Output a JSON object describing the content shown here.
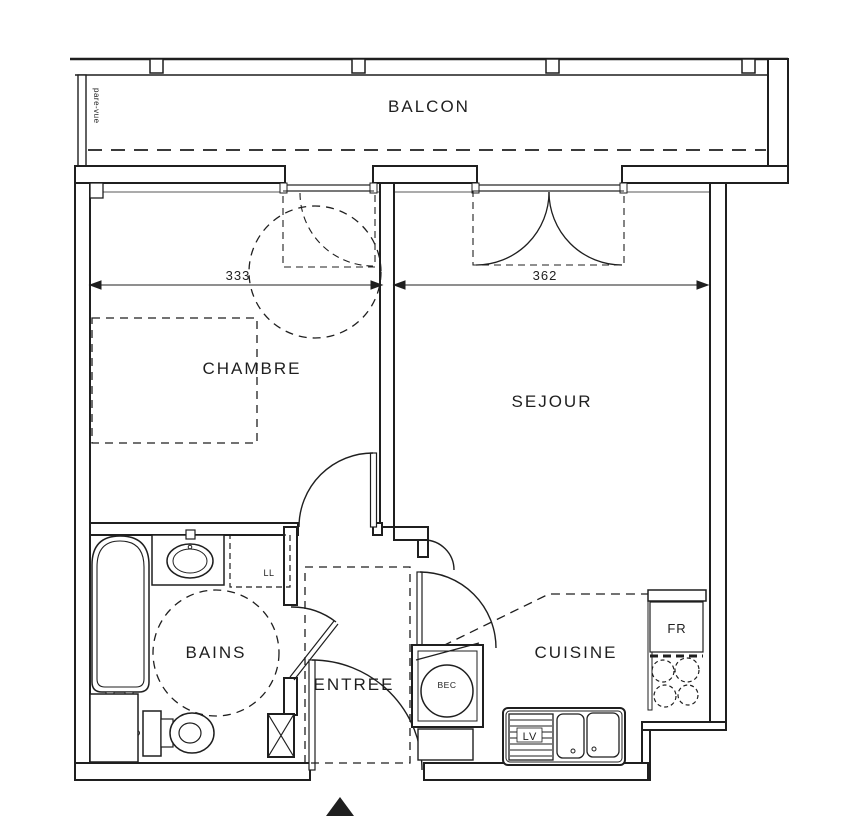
{
  "rooms": {
    "balcon": "BALCON",
    "chambre": "CHAMBRE",
    "sejour": "SEJOUR",
    "bains": "BAINS",
    "entree": "ENTREE",
    "cuisine": "CUISINE"
  },
  "dimensions": {
    "chambre_width": "333",
    "sejour_width": "362"
  },
  "equipment": {
    "washing_machine": "LL",
    "dishwasher": "LV",
    "fridge": "FR",
    "water_heater": "BEC"
  },
  "annotations": {
    "privacy_screen": "pare-vue"
  },
  "colors": {
    "ink": "#1f1f1f",
    "paper": "#ffffff"
  }
}
